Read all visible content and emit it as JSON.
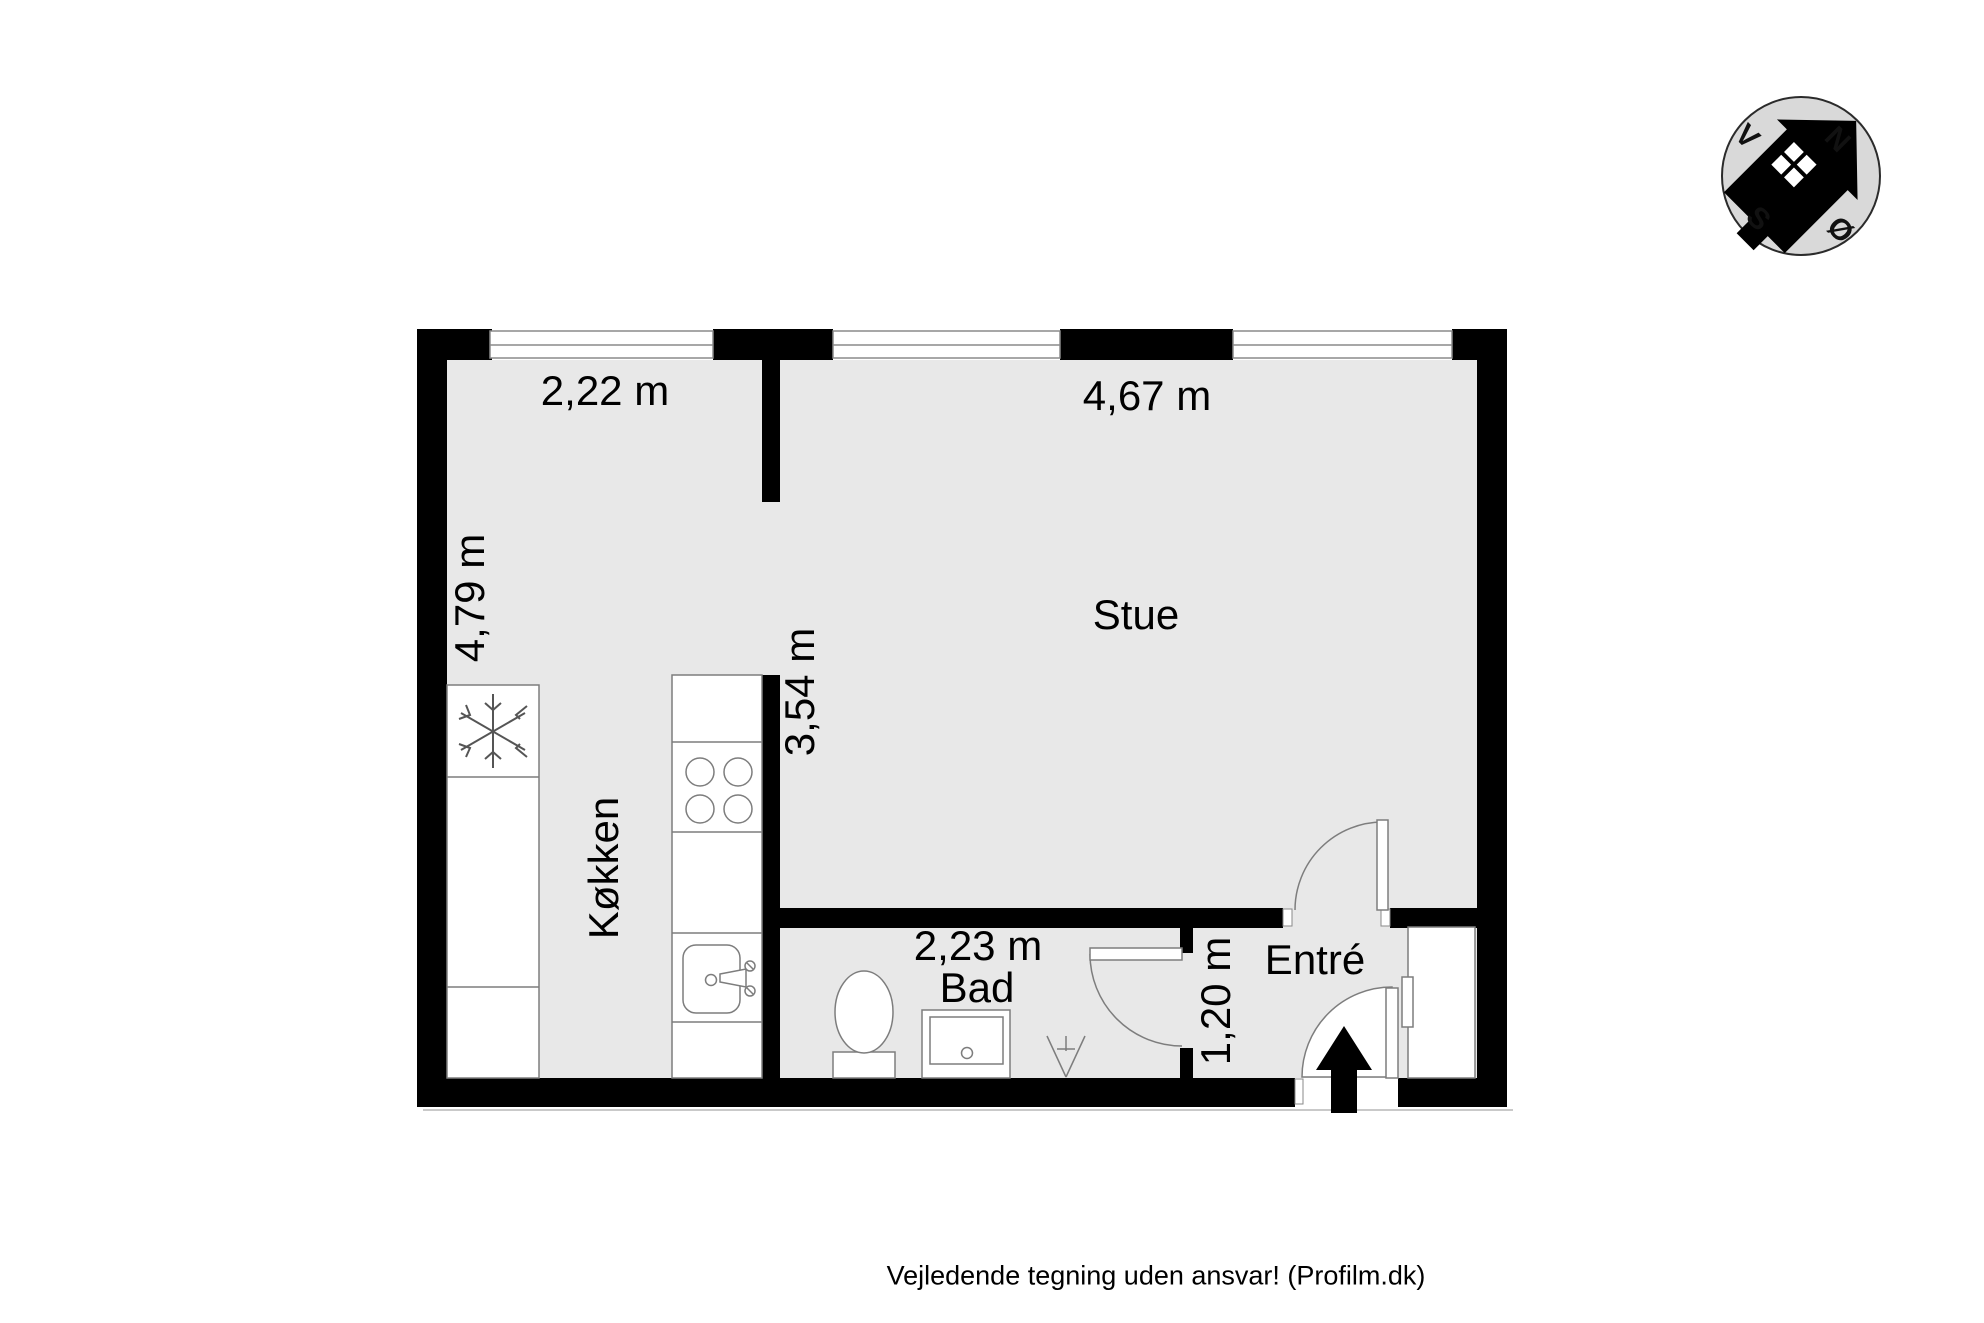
{
  "rooms": {
    "kitchen": {
      "label": "Køkken",
      "width": "2,22 m",
      "depth": "4,79 m"
    },
    "living": {
      "label": "Stue",
      "width": "4,67 m",
      "depth": "3,54 m"
    },
    "bath": {
      "label": "Bad",
      "width": "2,23 m"
    },
    "entry": {
      "label": "Entré",
      "depth": "1,20 m"
    }
  },
  "compass": {
    "north": "N",
    "west": "V",
    "south": "S",
    "east": "Ø"
  },
  "footer": {
    "disclaimer": "Vejledende tegning uden ansvar! (Profilm.dk)"
  },
  "colors": {
    "floor": "#e8e8e8",
    "wall": "#000000",
    "fixture_outline": "#7d7d7d",
    "compass_face": "#d9d9d9",
    "text": "#000000"
  }
}
